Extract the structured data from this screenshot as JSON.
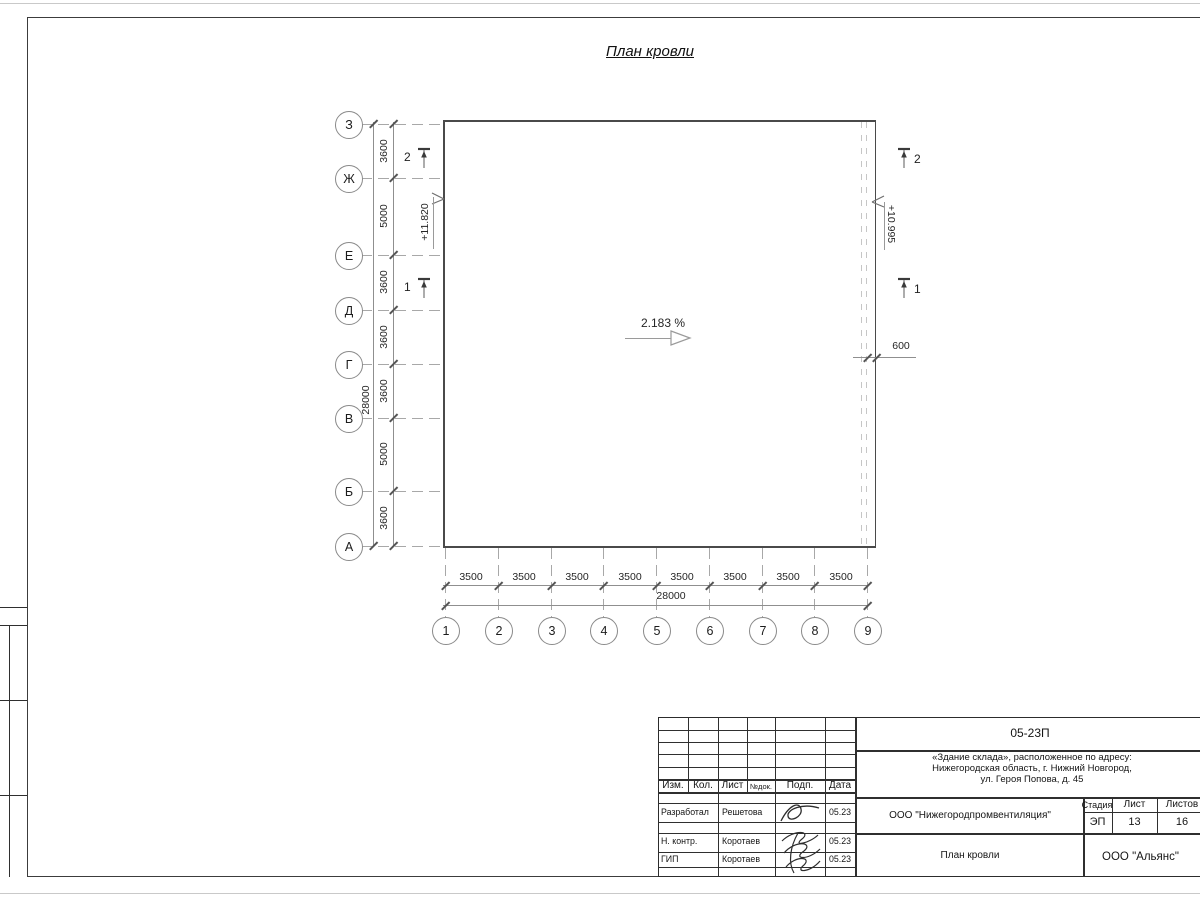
{
  "main_title": "План кровли",
  "plan": {
    "left_axes": [
      "З",
      "Ж",
      "Е",
      "Д",
      "Г",
      "В",
      "Б",
      "А"
    ],
    "left_dims": [
      "3600",
      "5000",
      "3600",
      "3600",
      "3600",
      "5000",
      "3600"
    ],
    "left_total": "28000",
    "bottom_axes": [
      "1",
      "2",
      "3",
      "4",
      "5",
      "6",
      "7",
      "8",
      "9"
    ],
    "bottom_dims": [
      "3500",
      "3500",
      "3500",
      "3500",
      "3500",
      "3500",
      "3500",
      "3500"
    ],
    "bottom_total": "28000",
    "slope_label": "2.183 %",
    "elevation_left": "+11.820",
    "elevation_right": "+10.995",
    "edge_offset": "600",
    "section_1": "1",
    "section_2": "2"
  },
  "title_block": {
    "doc_code": "05-23П",
    "project_line1": "«Здание склада», расположенное по адресу:",
    "project_line2": "Нижегородская область, г. Нижний Новгород,",
    "project_line3": "ул. Героя Попова, д. 45",
    "header": {
      "izm": "Изм.",
      "kol": "Кол.",
      "list": "Лист",
      "ndok": "№док.",
      "podp": "Подп.",
      "data": "Дата"
    },
    "rows": [
      {
        "role": "Разработал",
        "name": "Решетова",
        "date": "05.23"
      },
      {
        "role": "Н. контр.",
        "name": "Коротаев",
        "date": "05.23"
      },
      {
        "role": "ГИП",
        "name": "Коротаев",
        "date": "05.23"
      }
    ],
    "designer_org": "ООО \"Нижегородпромвентиляция\"",
    "sheet_title": "План кровли",
    "customer_org": "ООО \"Альянс\"",
    "stage_label": "Стадия",
    "sheet_label": "Лист",
    "sheets_label": "Листов",
    "stage": "ЭП",
    "sheet_no": "13",
    "sheets_total": "16"
  },
  "colors": {
    "line_dark": "#2f2f2f",
    "line_dim": "#8f8f8f",
    "wall": "#4a4a4a"
  }
}
